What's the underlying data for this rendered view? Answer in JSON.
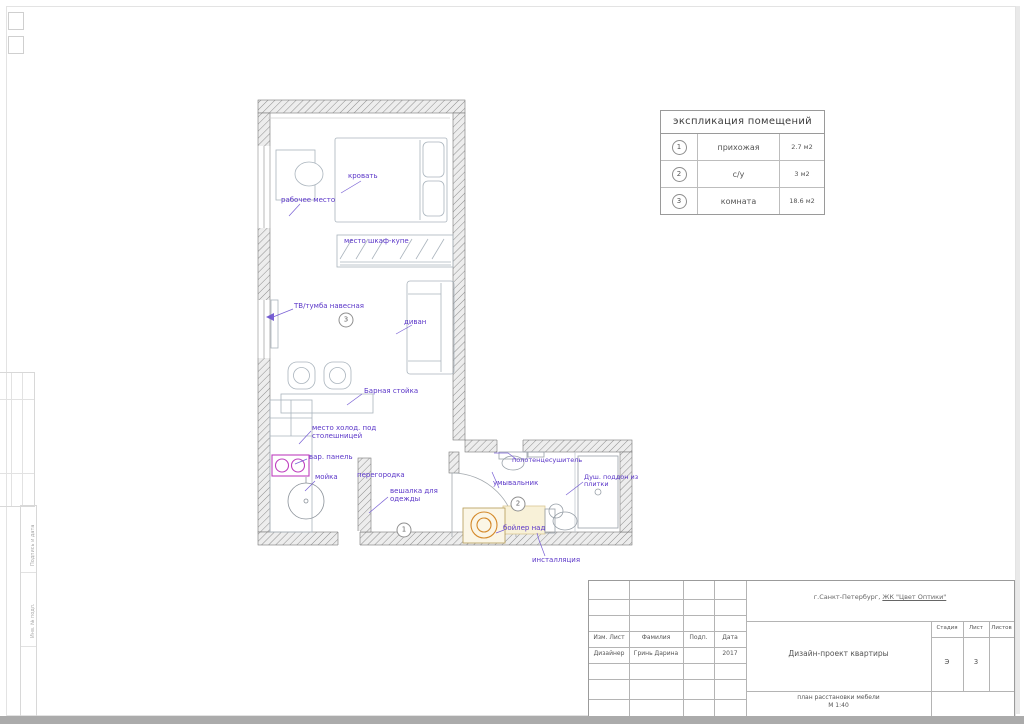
{
  "explication": {
    "title": "экспликация помещений",
    "rows": [
      {
        "num": "1",
        "name": "прихожая",
        "area": "2.7 м2"
      },
      {
        "num": "2",
        "name": "с/у",
        "area": "3 м2"
      },
      {
        "num": "3",
        "name": "комната",
        "area": "18.6 м2"
      }
    ]
  },
  "plan": {
    "labels": {
      "workplace": "рабочее место",
      "bed": "кровать",
      "wardrobe": "место шкаф-купе",
      "tv": "ТВ/тумба навесная",
      "sofa": "диван",
      "bar": "Барная стойка",
      "fridge": "место холод. под\nстолешницей",
      "hob": "вар. панель",
      "sink": "мойка",
      "partition": "перегородка",
      "hanger": "вешалка для\nодежды",
      "towel": "полотенцесушитель",
      "basin": "умывальник",
      "shower": "Душ. поддон из\nплитки",
      "boiler": "бойлер над",
      "installation": "инсталляция"
    },
    "markers": {
      "room1": "1",
      "room2": "2",
      "room3": "3"
    }
  },
  "titleblock": {
    "location_prefix": "г.Санкт-Петербург, ",
    "location_name": "ЖК \"Цвет Оптики\"",
    "project": "Дизайн-проект квартиры",
    "sheet_caption": "план расстановки мебели\nМ 1:40",
    "col_izm_list": "Изм. Лист",
    "col_fam": "Фамилия",
    "col_podp": "Подп.",
    "col_data": "Дата",
    "row_role": "Дизайнер",
    "row_name": "Гринь Дарина",
    "row_date": "2017",
    "stage_label": "Стадия",
    "list_label": "Лист",
    "listov_label": "Листов",
    "stage_value": "Э",
    "list_value": "3"
  },
  "frame": {
    "v_label_1": "Подпись и дата",
    "v_label_2": "Инв. № подл."
  },
  "colors": {
    "accent": "#5a35c8",
    "cooktop": "#bf40bf",
    "washer": "#d4892a"
  }
}
